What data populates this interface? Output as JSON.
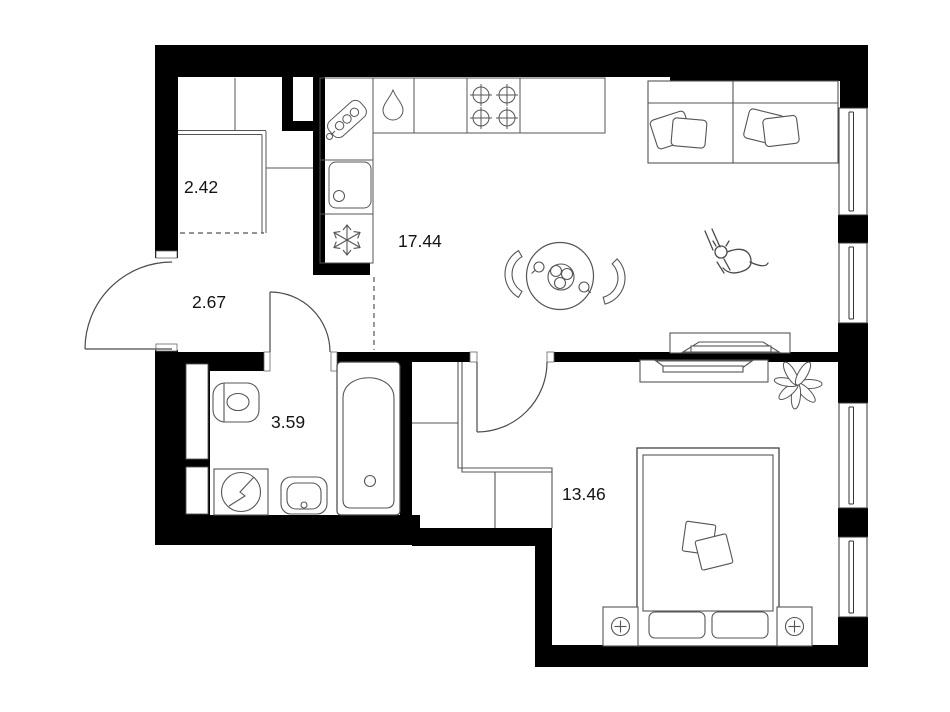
{
  "plan": {
    "type": "apartment-floor-plan",
    "rooms": [
      {
        "id": "storage",
        "label": "2.42"
      },
      {
        "id": "hallway",
        "label": "2.67"
      },
      {
        "id": "kitchen-living-room",
        "label": "17.44"
      },
      {
        "id": "bathroom",
        "label": "3.59"
      },
      {
        "id": "bedroom",
        "label": "13.46"
      }
    ],
    "icons": [
      "electric-panel-icon",
      "water-drop-icon",
      "kitchen-sink-icon",
      "freezer-snowflake-icon",
      "stove-burner-icon",
      "dining-table",
      "chair-icon",
      "sofa",
      "pillow-icon",
      "cat-icon",
      "tv-stand",
      "plant-icon",
      "bed",
      "nightstand-lamp-icon",
      "wardrobe-outline",
      "toilet-icon",
      "washing-machine-icon",
      "bathroom-sink-icon",
      "bathtub-icon",
      "door-swing-arc",
      "window",
      "duct-shaft"
    ],
    "colors": {
      "wall": "#000000",
      "fixture_line": "#4d4d4d",
      "background": "#ffffff",
      "text": "#141414"
    }
  }
}
